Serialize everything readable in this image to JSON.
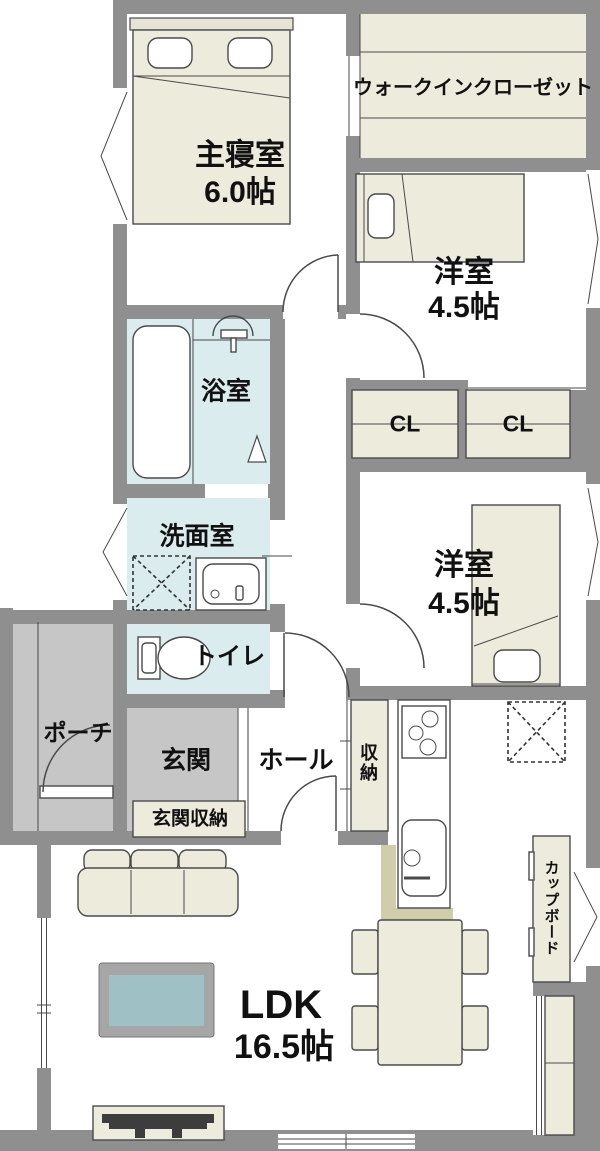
{
  "rooms": {
    "master_bedroom": {
      "name": "主寝室",
      "size": "6.0帖"
    },
    "walk_in_closet": {
      "name": "ウォークインクローゼット"
    },
    "bedroom_upper": {
      "name": "洋室",
      "size": "4.5帖"
    },
    "bedroom_lower": {
      "name": "洋室",
      "size": "4.5帖"
    },
    "bathroom": {
      "name": "浴室"
    },
    "washroom": {
      "name": "洗面室"
    },
    "toilet": {
      "name": "トイレ"
    },
    "closet_left": {
      "name": "CL"
    },
    "closet_right": {
      "name": "CL"
    },
    "porch": {
      "name": "ポーチ"
    },
    "entrance": {
      "name": "玄関"
    },
    "hall": {
      "name": "ホール"
    },
    "storage": {
      "name": "収納"
    },
    "entrance_storage": {
      "name": "玄関収納"
    },
    "cupboard": {
      "name": "カップボード"
    },
    "ldk": {
      "name": "LDK",
      "size": "16.5帖"
    }
  },
  "colors": {
    "wall": "#8f8f8f",
    "wet_room": "#daecee",
    "furniture_cream": "#edebdc",
    "porch_gray": "#c6c6c6",
    "counter_khaki": "#cfcdaa",
    "rug_blue": "#9fc1c5",
    "line": "#444444"
  }
}
